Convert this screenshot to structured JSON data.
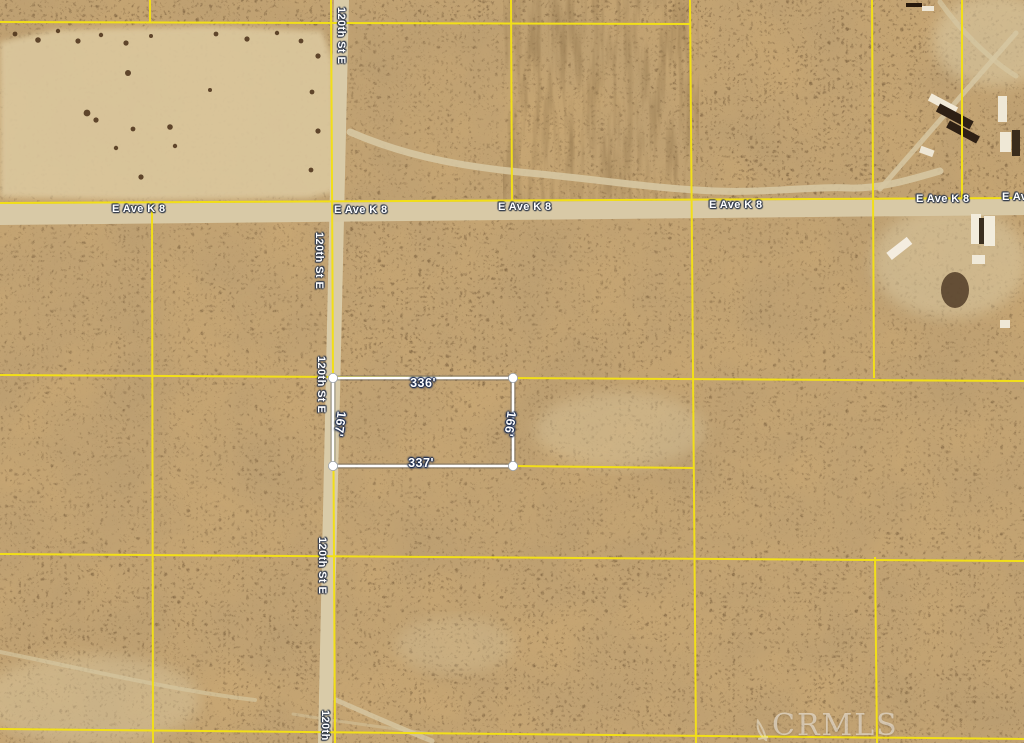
{
  "map_overlay": {
    "parcel_dimensions": {
      "top": "336'",
      "bottom": "337'",
      "left_side": "167'",
      "right_side": "166'"
    },
    "street_labels": {
      "north_south_road": "120th St E",
      "east_west_road": "E Ave K 8"
    },
    "watermark_label": "CRMLS",
    "colors": {
      "lot_line_yellow": "#f2df18",
      "parcel_outline_white": "#ffffff",
      "dimension_text": "#ffffff",
      "street_label_text": "#ffffff",
      "terrain_base": "#c7a673"
    }
  }
}
